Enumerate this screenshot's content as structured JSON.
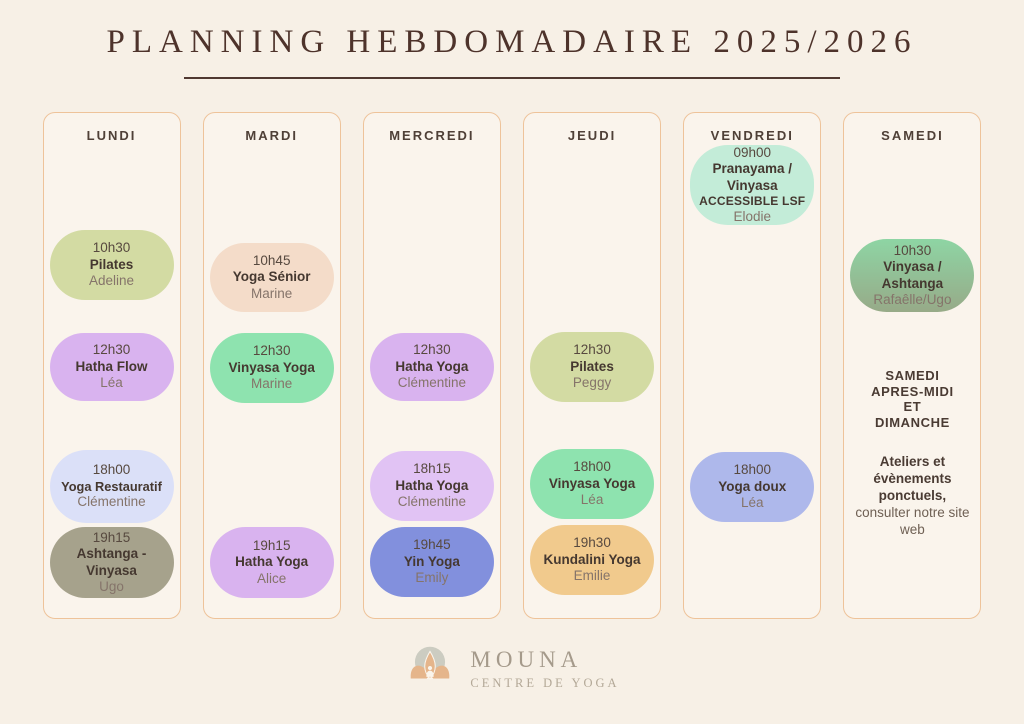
{
  "page": {
    "title": "PLANNING HEBDOMADAIRE 2025/2026",
    "background_color": "#f7f0e6",
    "title_color": "#4e332b",
    "column_border_color": "#eec39a"
  },
  "columns": [
    {
      "day": "LUNDI",
      "events": [
        {
          "time": "10h30",
          "name": "Pilates",
          "teacher": "Adeline",
          "color": "#d3dba3"
        },
        {
          "time": "12h30",
          "name": "Hatha Flow",
          "teacher": "Léa",
          "color": "#d9b3ef"
        },
        {
          "time": "18h00",
          "name": "Yoga Restauratif",
          "teacher": "Clémentine",
          "color": "#dbe0f8"
        },
        {
          "time": "19h15",
          "name": "Ashtanga - Vinyasa",
          "teacher": "Ugo",
          "color": "#a6a28c"
        }
      ]
    },
    {
      "day": "MARDI",
      "events": [
        {
          "time": "10h45",
          "name": "Yoga Sénior",
          "teacher": "Marine",
          "color": "#f4dcc9"
        },
        {
          "time": "12h30",
          "name": "Vinyasa Yoga",
          "teacher": "Marine",
          "color": "#8ee3af"
        },
        {
          "time": "19h15",
          "name": "Hatha Yoga",
          "teacher": "Alice",
          "color": "#d9b3ef"
        }
      ]
    },
    {
      "day": "MERCREDI",
      "events": [
        {
          "time": "12h30",
          "name": "Hatha Yoga",
          "teacher": "Clémentine",
          "color": "#d9b3ef"
        },
        {
          "time": "18h15",
          "name": "Hatha Yoga",
          "teacher": "Clémentine",
          "color": "#e1c3f4"
        },
        {
          "time": "19h45",
          "name": "Yin Yoga",
          "teacher": "Emily",
          "color": "#8290dd"
        }
      ]
    },
    {
      "day": "JEUDI",
      "events": [
        {
          "time": "12h30",
          "name": "Pilates",
          "teacher": "Peggy",
          "color": "#d3dba3"
        },
        {
          "time": "18h00",
          "name": "Vinyasa Yoga",
          "teacher": "Léa",
          "color": "#8ee3af"
        },
        {
          "time": "19h30",
          "name": "Kundalini Yoga",
          "teacher": "Emilie",
          "color": "#f1ca8d"
        }
      ]
    },
    {
      "day": "VENDREDI",
      "events": [
        {
          "time": "09h00",
          "name": "Pranayama / Vinyasa",
          "note": "ACCESSIBLE LSF",
          "teacher": "Elodie",
          "color": "#c3ecd8"
        },
        {
          "time": "18h00",
          "name": "Yoga doux",
          "teacher": "Léa",
          "color": "#aeb8eb"
        }
      ]
    },
    {
      "day": "SAMEDI",
      "events": [
        {
          "time": "10h30",
          "name": "Vinyasa / Ashtanga",
          "teacher": "Rafaêlle/Ugo",
          "color": [
            "#8ed5a4",
            "#97aa88"
          ]
        }
      ],
      "info": {
        "heading": "SAMEDI\nAPRES-MIDI\nET\nDIMANCHE",
        "bold_text": "Ateliers et évènements ponctuels,",
        "regular_text": "consulter notre site web"
      }
    }
  ],
  "footer": {
    "brand": "MOUNA",
    "subtitle": "CENTRE DE YOGA"
  }
}
